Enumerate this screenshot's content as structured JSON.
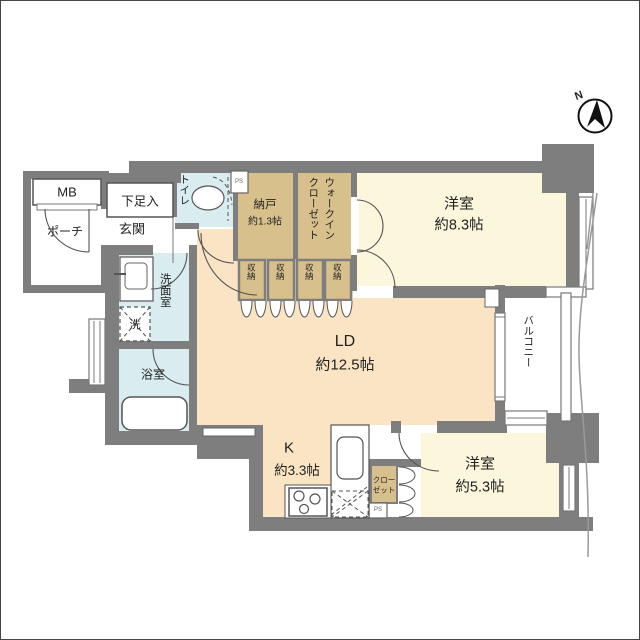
{
  "title": "apartment-floor-plan",
  "compass": {
    "label": "N"
  },
  "colors": {
    "wall": "#7e7e7e",
    "room_cream": "#FBF6DC",
    "room_peach": "#FAE4C3",
    "closet_tan": "#D8C08D",
    "wet_area_blue": "#D9EDF1",
    "line": "#555555",
    "site_line": "#999999"
  },
  "rooms": {
    "mb": {
      "label": "MB"
    },
    "porch": {
      "label": "ポーチ"
    },
    "shoe_cabinet": {
      "label": "下足入"
    },
    "entrance": {
      "label": "玄関"
    },
    "toilet": {
      "label": "トイレ"
    },
    "ps_top": {
      "label": "PS"
    },
    "storage_room": {
      "label": "納戸",
      "size": "約1.3帖"
    },
    "walk_in_closet": {
      "label_col1": "ウォークイン",
      "label_col2": "クローゼット"
    },
    "bedroom1": {
      "label": "洋室",
      "size": "約8.3帖"
    },
    "washroom": {
      "label": "洗面室"
    },
    "washer": {
      "label": "洗"
    },
    "bath": {
      "label": "浴室"
    },
    "living_dining": {
      "label": "LD",
      "size": "約12.5帖"
    },
    "balcony": {
      "label": "バルコニー"
    },
    "kitchen": {
      "label": "K",
      "size": "約3.3帖"
    },
    "closet": {
      "label_line1": "クロー",
      "label_line2": "ゼット"
    },
    "ps_bottom": {
      "label": "PS"
    },
    "bedroom2": {
      "label": "洋室",
      "size": "約5.3帖"
    }
  },
  "storage_units": [
    {
      "label": "収納"
    },
    {
      "label": "収納"
    },
    {
      "label": "収納"
    },
    {
      "label": "収納"
    }
  ]
}
